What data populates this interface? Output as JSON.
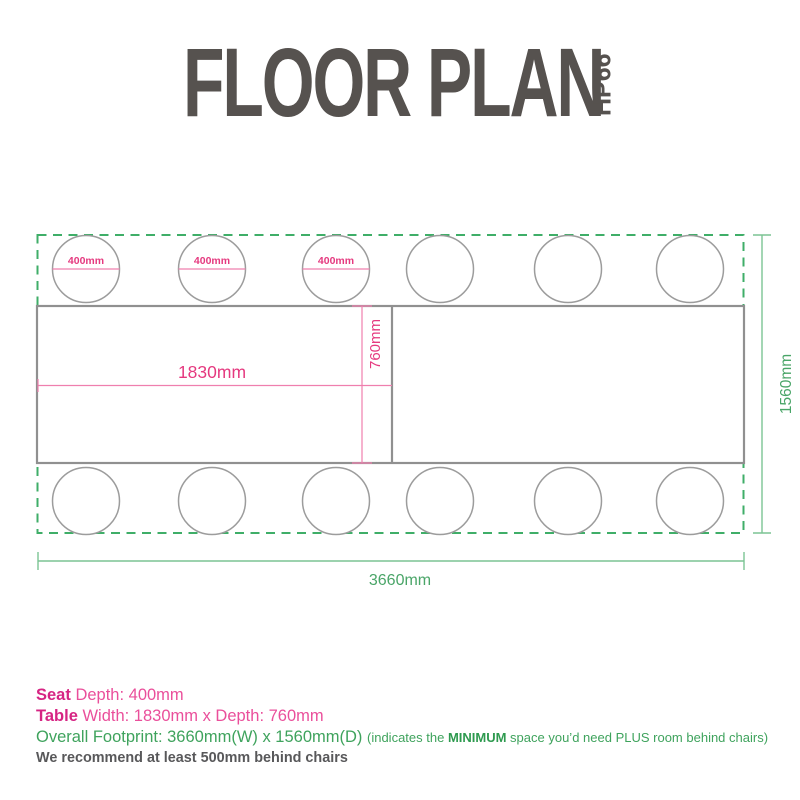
{
  "header": {
    "title": "FLOOR PLAN",
    "model": "HP66"
  },
  "dimensions": {
    "seat_diameter": "400mm",
    "table_width": "1830mm",
    "table_depth": "760mm",
    "overall_width": "3660mm",
    "overall_depth": "1560mm"
  },
  "colors": {
    "pink_text": "#e5397f",
    "pink_line": "#ef7fae",
    "green_dash": "#3fae68",
    "green_line": "#7cc494",
    "green_text": "#4aa568",
    "gray_line": "#909090",
    "title_gray": "#56524f"
  },
  "footer": {
    "seat_bold": "Seat",
    "seat_rest": " Depth: 400mm",
    "table_bold": "Table",
    "table_rest": " Width: 1830mm x Depth: 760mm",
    "overall_main": "Overall Footprint: 3660mm(W) x 1560mm(D) ",
    "overall_note_pre": "(indicates the ",
    "overall_note_bold": "MINIMUM",
    "overall_note_post": " space you’d need PLUS room behind chairs)",
    "recommend": "We recommend at least 500mm behind chairs"
  }
}
